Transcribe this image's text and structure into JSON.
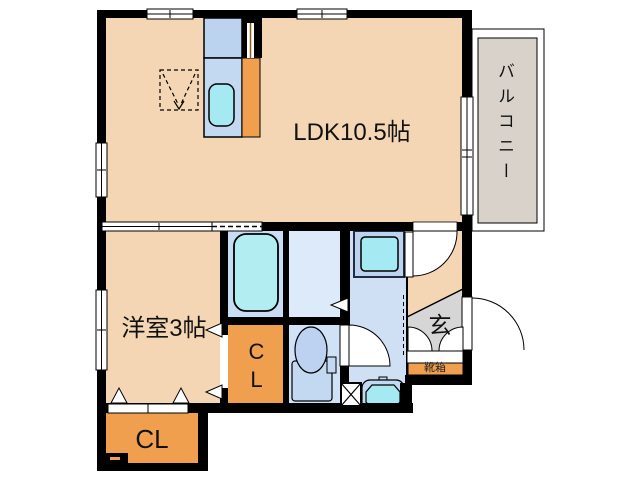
{
  "floorplan": {
    "labels": {
      "ldk": "LDK10.5帖",
      "western_room": "洋室3帖",
      "closet_middle": "CL",
      "closet_bottom": "CL",
      "balcony": "バルコニー",
      "entrance": "玄",
      "shoe_box": "靴箱"
    },
    "colors": {
      "room_floor": "#f4d6b4",
      "closet_orange": "#ef9f4e",
      "balcony_gray": "#d9d2ca",
      "entrance_gray": "#d6d6d6",
      "bath_floor": "#c8dcf3",
      "washroom_floor": "#dceafa",
      "toilet_floor": "#cfe2f6",
      "corridor_floor": "#cfdff4",
      "counter_blue": "#c3d9f1",
      "fixture_cyan": "#a5e9f2",
      "tub_cyan": "#b2edf2",
      "appliance_blue": "#bcd3ef",
      "toilet_bowl": "#bdd2f0",
      "wall": "#000000"
    }
  }
}
